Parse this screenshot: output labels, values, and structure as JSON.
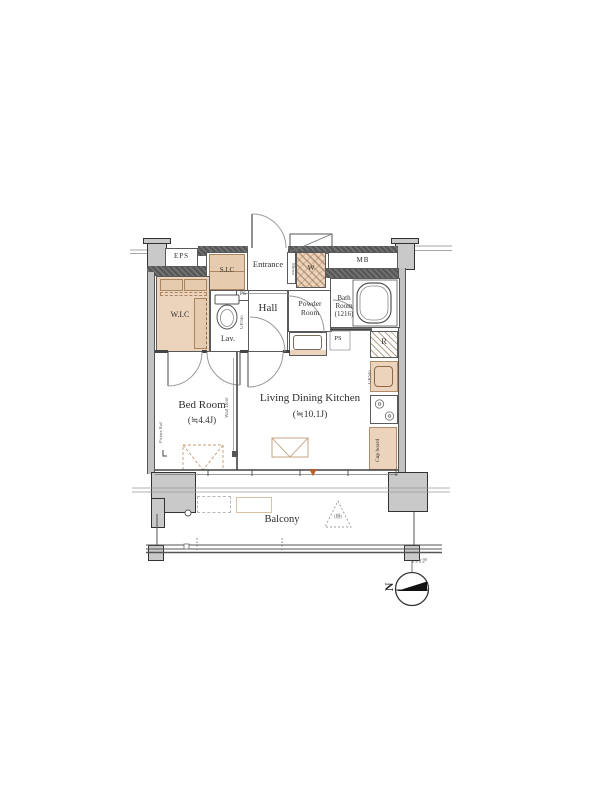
{
  "plan": {
    "labels": {
      "eps": "EPS",
      "sic": "S.I.C",
      "entrance": "Entrance",
      "mirror": "Mirror",
      "washer": "W",
      "mb": "MB",
      "wic": "W.I.C",
      "ps_top": "PS",
      "hall": "Hall",
      "lav": "Lav.",
      "lav_storage": "UP.Sto",
      "powder": "Powder\nRoom",
      "ps_mid": "PS",
      "bath": "Bath\nRoom\n(1216)",
      "fridge": "R",
      "kitchen_storage": "UP.Sto",
      "cupboard": "Cup board",
      "bedroom": "Bed Room",
      "bedroom_size": "(≒4.4J)",
      "ldk": "Living Dining Kitchen",
      "ldk_size": "(≒10.1J)",
      "wall_door": "Wall Door",
      "picture_rail": "Picture Rail",
      "balcony": "Balcony",
      "hatch_note": "(樋)",
      "compass_n": "N",
      "dim_note": "6-90"
    },
    "colors": {
      "accent_beige": "#ecd4bc",
      "wall_dark": "#575757",
      "wall_gray": "#c2c2c2",
      "marker_orange": "#b4622d",
      "line": "#444444"
    }
  }
}
